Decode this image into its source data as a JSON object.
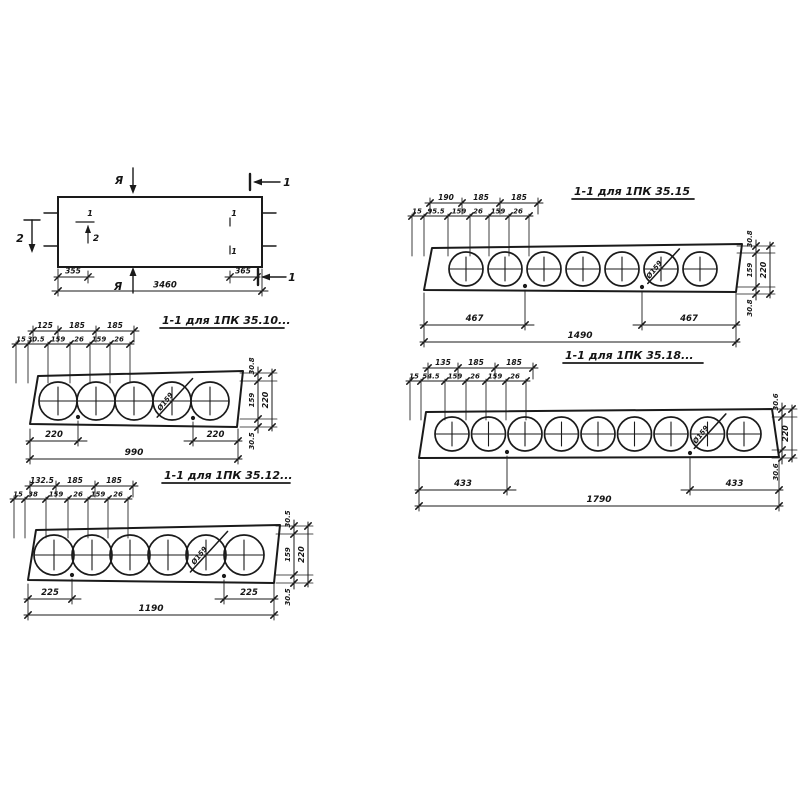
{
  "drawing_ink": "#1a1a1a",
  "plan": {
    "view_mark_top": "Я",
    "view_mark_bottom": "Я",
    "cut_label_top_right": "1",
    "cut_label_bottom_right": "1",
    "cut_label_left": "2",
    "inner_marks": {
      "m1": "1",
      "m2": "2",
      "m3": "1",
      "m4": "1"
    },
    "dims": {
      "left": "355",
      "total": "3460",
      "right": "365"
    }
  },
  "sections": [
    {
      "title": "1-1 для 1ПК 35.10...",
      "core": {
        "count": 5,
        "marked_index": 3,
        "diameter_label": "Ø159"
      },
      "dims_row1": [
        "125",
        "185",
        "185"
      ],
      "dims_row2": [
        "15",
        "30.5",
        "159",
        "26",
        "159",
        "26"
      ],
      "dims_right": {
        "top": "30.8",
        "core": "159",
        "bottom": "30.5",
        "overall": "220"
      },
      "dims_bottom": {
        "left": "220",
        "total": "990",
        "right": "220"
      }
    },
    {
      "title": "1-1 для 1ПК 35.12...",
      "core": {
        "count": 6,
        "marked_index": 4,
        "diameter_label": "Ø159"
      },
      "dims_row1": [
        "132.5",
        "185",
        "185"
      ],
      "dims_row2": [
        "15",
        "38",
        "159",
        "26",
        "159",
        "26"
      ],
      "dims_right": {
        "top": "30.5",
        "core": "159",
        "bottom": "30.5",
        "overall": "220"
      },
      "dims_bottom": {
        "left": "225",
        "total": "1190",
        "right": "225"
      }
    },
    {
      "title": "1-1 для 1ПК 35.15",
      "core": {
        "count": 7,
        "marked_index": 5,
        "diameter_label": "Ø159"
      },
      "dims_row1": [
        "190",
        "185",
        "185"
      ],
      "dims_row2": [
        "15",
        "95.5",
        "159",
        "26",
        "159",
        "26"
      ],
      "dims_right": {
        "top": "30.8",
        "core": "159",
        "bottom": "30.8",
        "overall": "220"
      },
      "dims_bottom": {
        "left": "467",
        "total": "1490",
        "right": "467"
      }
    },
    {
      "title": "1-1 для 1ПК 35.18...",
      "core": {
        "count": 9,
        "marked_index": 7,
        "diameter_label": "Ø159"
      },
      "dims_row1": [
        "135",
        "185",
        "185"
      ],
      "dims_row2": [
        "15",
        "54.5",
        "159",
        "26",
        "159",
        "26"
      ],
      "dims_right": {
        "top": "30.6",
        "bottom": "30.6",
        "overall": "220"
      },
      "dims_bottom": {
        "left": "433",
        "total": "1790",
        "right": "433"
      }
    }
  ]
}
